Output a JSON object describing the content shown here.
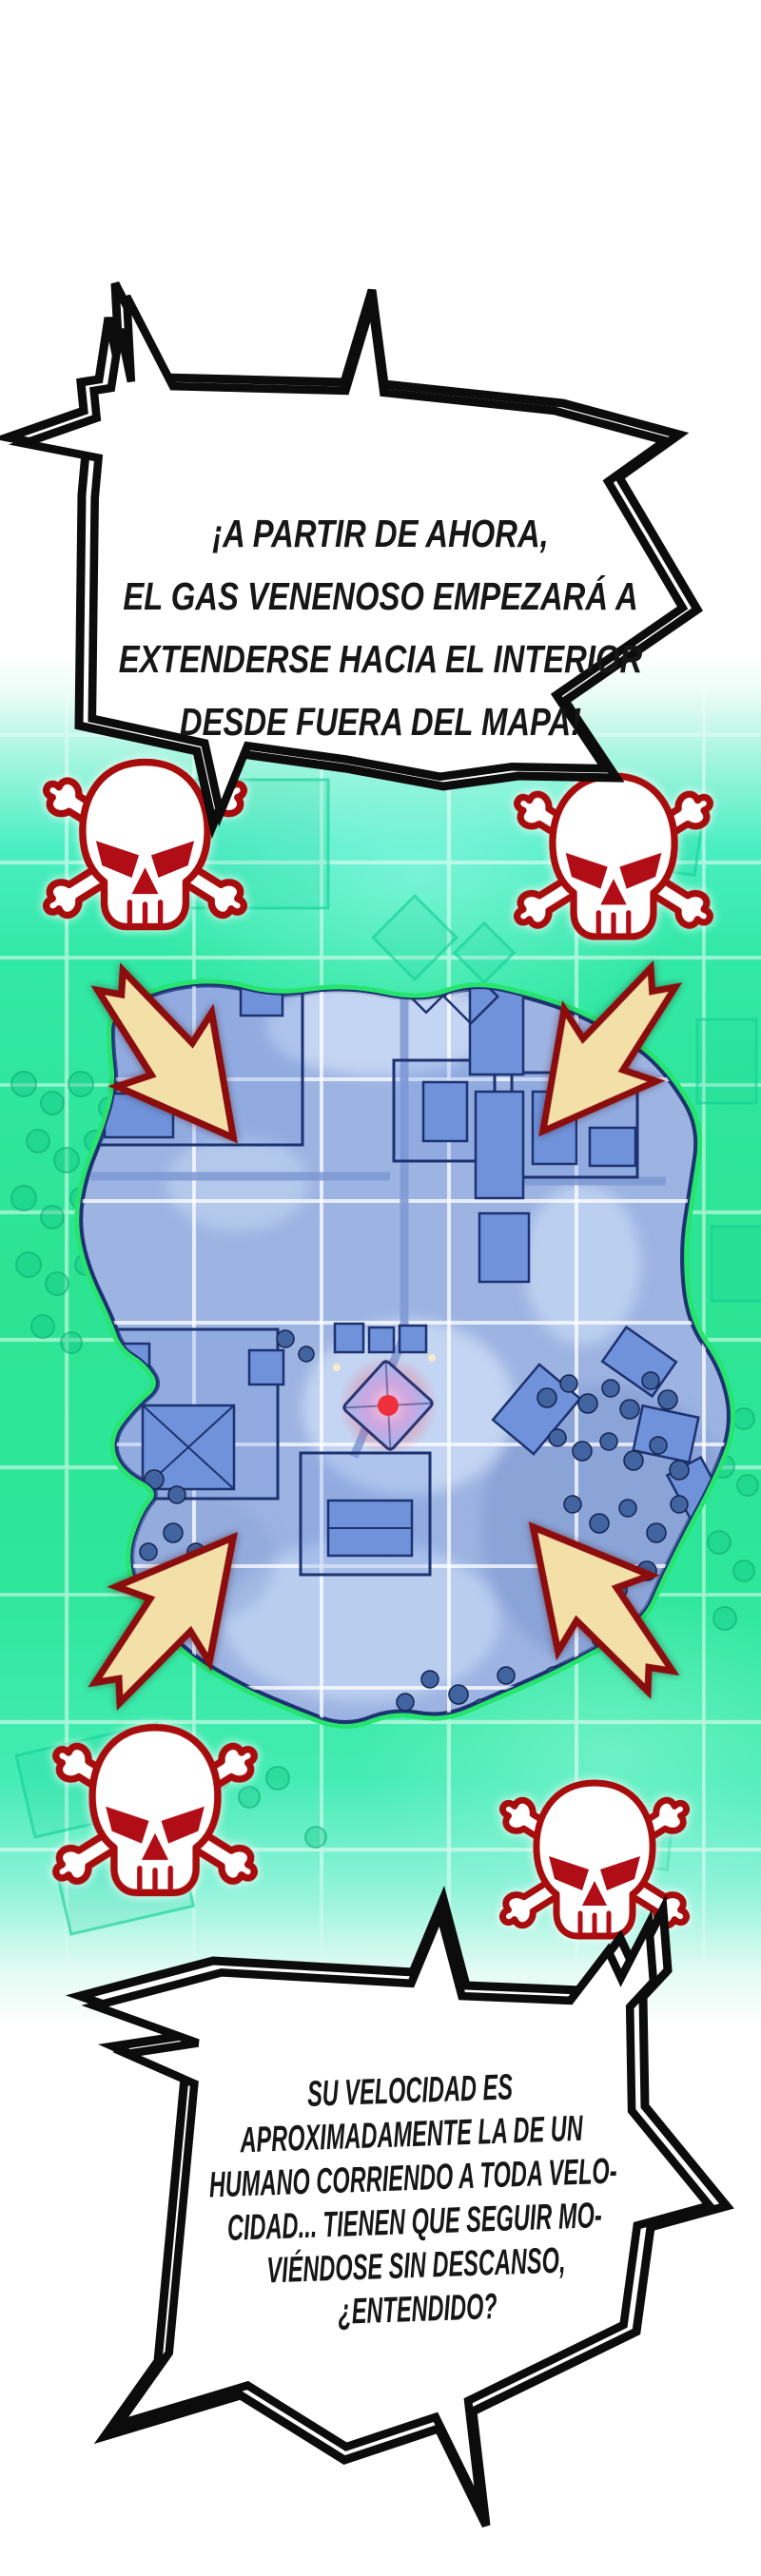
{
  "scene": {
    "type": "webtoon-panel-battle-royale-map",
    "top_bubble": {
      "lines": [
        "¡A PARTIR DE AHORA,",
        "EL GAS VENENOSO EMPEZARÁ A",
        "EXTENDERSE HACIA EL INTERIOR",
        "DESDE FUERA DEL MAPA!"
      ]
    },
    "bottom_bubble": {
      "lines": [
        "SU VELOCIDAD ES",
        "APROXIMADAMENTE LA DE UN",
        "HUMANO CORRIENDO A TODA VELO-",
        "CIDAD... TIENEN QUE SEGUIR MO-",
        "VIÉNDOSE SIN DESCANSO,",
        "¿ENTENDIDO?"
      ]
    },
    "icons": {
      "skull": "skull-crossbones-icon",
      "arrow": "inward-arrow-icon",
      "marker": "red-glow-zone-marker"
    },
    "colors": {
      "gas_green": "#2ee593",
      "gas_aqua": "#5beed2",
      "map_blue": "#9db3e2",
      "map_ice": "#cadbf5",
      "building_blue": "#6f92da",
      "map_outline": "#1d3270",
      "blob_rim_green": "#27e46e",
      "arrow_fill": "#f3dfa8",
      "arrow_outline": "#8c1110",
      "skull_red": "#a8100f",
      "grid_white": "#ffffff",
      "ink": "#141414"
    }
  }
}
